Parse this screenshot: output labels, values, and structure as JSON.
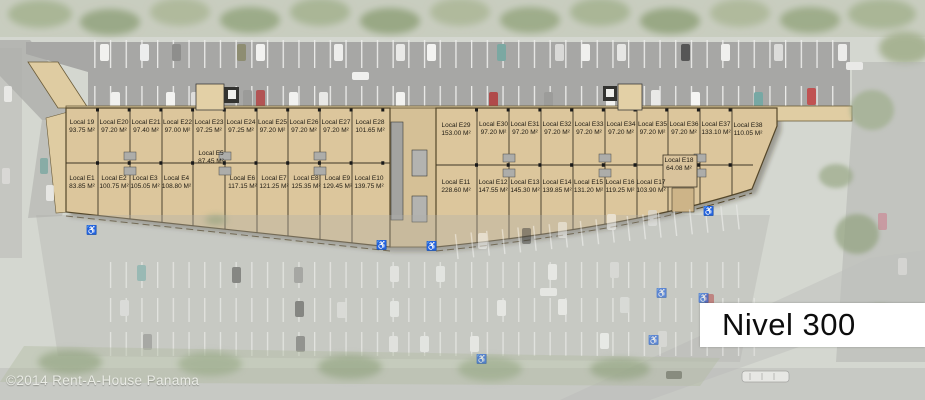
{
  "plan": {
    "level_label": "Nivel 300",
    "watermark": "©2014 Rent-A-House Panama",
    "area_unit": "M²"
  },
  "icons": {
    "wheelchair": "♿"
  },
  "colors": {
    "building_fill": "#dcc69c",
    "building_outline": "#54472a",
    "walkway_fill": "#e0cda3",
    "asphalt": "#a7a7a5",
    "accessible_blue": "#2f7cc9",
    "label_box_bg": "#ffffff",
    "label_text": "#0d0d0d",
    "tree_green": "#9fae8c"
  },
  "units": {
    "upper_left": [
      {
        "label": "Local 19",
        "area": "93.75 M²"
      },
      {
        "label": "Local E20",
        "area": "97.20 M²"
      },
      {
        "label": "Local E21",
        "area": "97.40 M²"
      },
      {
        "label": "Local E22",
        "area": "97.00 M²"
      },
      {
        "label": "Local E23",
        "area": "97.25 M²"
      },
      {
        "label": "Local E24",
        "area": "97.25 M²"
      },
      {
        "label": "Local E25",
        "area": "97.20 M²"
      },
      {
        "label": "Local E26",
        "area": "97.20 M²"
      },
      {
        "label": "Local E27",
        "area": "97.20 M²"
      },
      {
        "label": "Local E28",
        "area": "101.65 M²"
      }
    ],
    "upper_right": [
      {
        "label": "Local E29",
        "area": "153.00 M²"
      },
      {
        "label": "Local E30",
        "area": "97.20 M²"
      },
      {
        "label": "Local E31",
        "area": "97.20 M²"
      },
      {
        "label": "Local E32",
        "area": "97.20 M²"
      },
      {
        "label": "Local E33",
        "area": "97.20 M²"
      },
      {
        "label": "Local E34",
        "area": "97.20 M²"
      },
      {
        "label": "Local E35",
        "area": "97.20 M²"
      },
      {
        "label": "Local E36",
        "area": "97.20 M²"
      },
      {
        "label": "Local E37",
        "area": "133.10 M²"
      },
      {
        "label": "Local E38",
        "area": "110.05 M²"
      }
    ],
    "lower_left": [
      {
        "label": "Local E1",
        "area": "83.85 M²"
      },
      {
        "label": "Local E2",
        "area": "100.75 M²"
      },
      {
        "label": "Local E3",
        "area": "105.05 M²"
      },
      {
        "label": "Local E4",
        "area": "108.80 M²"
      },
      {
        "label": "Local E6",
        "area": "117.15 M²"
      },
      {
        "label": "Local E7",
        "area": "121.25 M²"
      },
      {
        "label": "Local E8",
        "area": "125.35 M²"
      },
      {
        "label": "Local E9",
        "area": "129.45 M²"
      },
      {
        "label": "Local E10",
        "area": "139.75 M²"
      }
    ],
    "unit_e5": {
      "label": "Local E5",
      "area": "87.45 M²"
    },
    "lower_right": [
      {
        "label": "Local E11",
        "area": "228.60 M²"
      },
      {
        "label": "Local E12",
        "area": "147.55 M²"
      },
      {
        "label": "Local E13",
        "area": "145.30 M²"
      },
      {
        "label": "Local E14",
        "area": "139.85 M²"
      },
      {
        "label": "Local E15",
        "area": "131.20 M²"
      },
      {
        "label": "Local E16",
        "area": "119.25 M²"
      },
      {
        "label": "Local E17",
        "area": "103.90 M²"
      }
    ],
    "unit_e18": {
      "label": "Local E18",
      "area": "64.08 M²"
    }
  }
}
